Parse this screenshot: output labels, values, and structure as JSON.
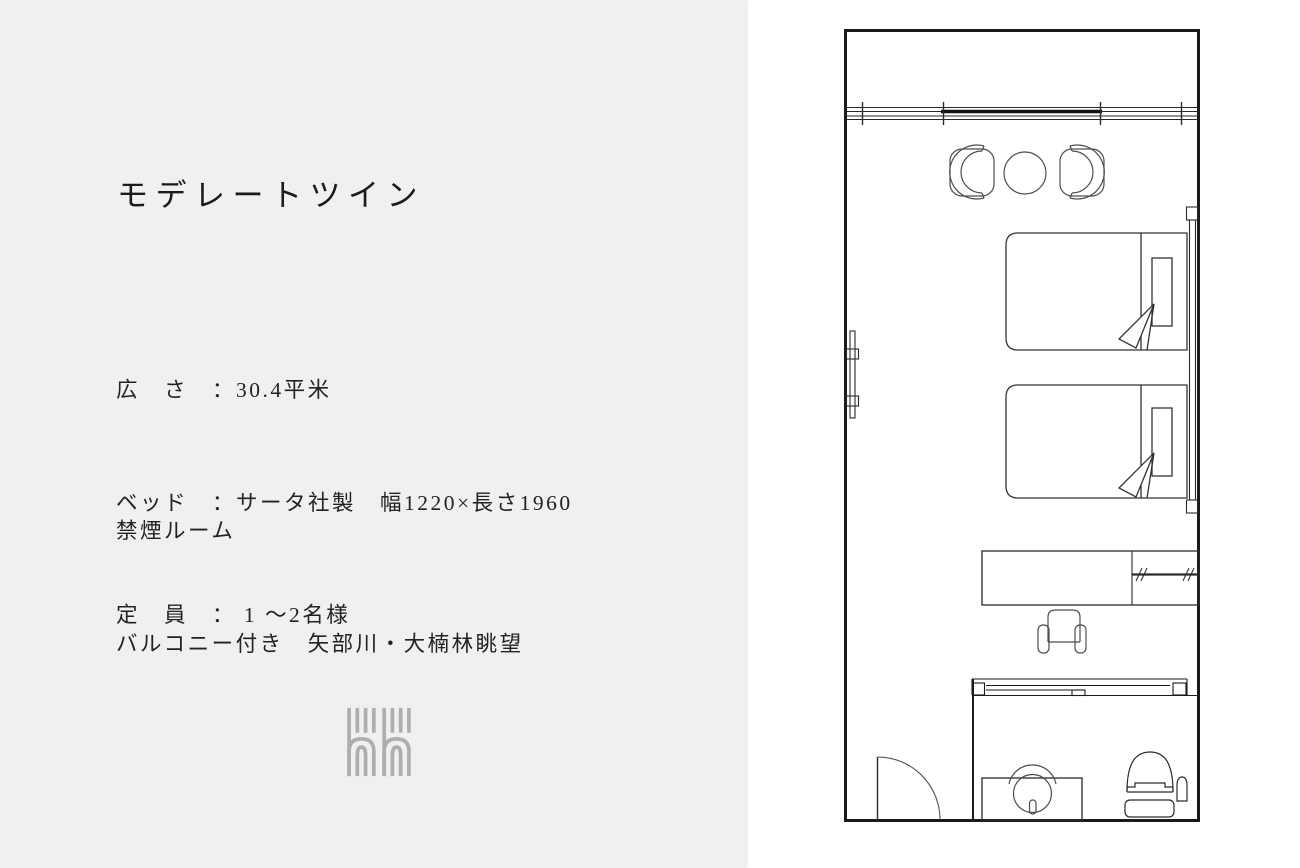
{
  "colors": {
    "panel_bg": "#f0f0ee",
    "page_bg": "#ffffff",
    "text": "#1b1b1b",
    "wall_line": "#1a1a1a",
    "furniture_line": "#3f3f3f",
    "logo_gray": "#aeaeae"
  },
  "room": {
    "title": "モデレートツイン",
    "specs": [
      "広　さ　：30.4平米",
      "ベッド　：サータ社製　幅1220×長さ1960",
      "定　員　： 1 〜2名様"
    ],
    "notes": [
      "禁煙ルーム",
      "バルコニー付き　矢部川・大楠林眺望"
    ]
  },
  "floor_plan": {
    "features": [
      "balcony",
      "window-sliding-glass-door",
      "lounge-chair-left",
      "round-table",
      "lounge-chair-right",
      "wall-mirror",
      "twin-bed-upper",
      "twin-bed-lower",
      "pillow",
      "duvet-fold",
      "headboard-panel",
      "desk-counter",
      "closet-hanger-rod",
      "armchair",
      "bathroom",
      "bathroom-sliding-door",
      "washbasin",
      "toilet",
      "entrance-door"
    ]
  }
}
